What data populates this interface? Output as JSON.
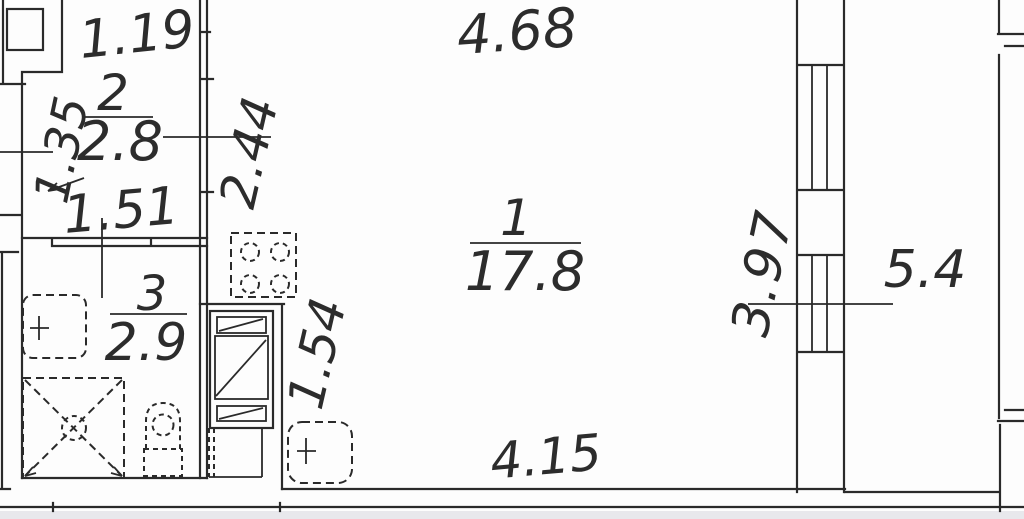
{
  "floorplan": {
    "rooms": [
      {
        "number": "2",
        "area": "2.8",
        "dims": {
          "top": "1.19",
          "left": "1.35",
          "bottom": "1.51",
          "right": "2.44"
        }
      },
      {
        "number": "1",
        "area": "17.8",
        "dims": {
          "top": "4.68",
          "bottom": "4.15",
          "niche": "1.54"
        }
      },
      {
        "number": "3",
        "area": "2.9"
      }
    ],
    "balcony": {
      "area": "5.4",
      "glazing_length": "3.97"
    },
    "fixtures": [
      "stove",
      "vent-shaft",
      "kitchen-cabinet",
      "washing-machine",
      "sink",
      "shower",
      "toilet"
    ],
    "colors": {
      "line": "#2a2a2a",
      "background": "#ffffff",
      "bottom_strip": "#e8e8ec"
    }
  }
}
